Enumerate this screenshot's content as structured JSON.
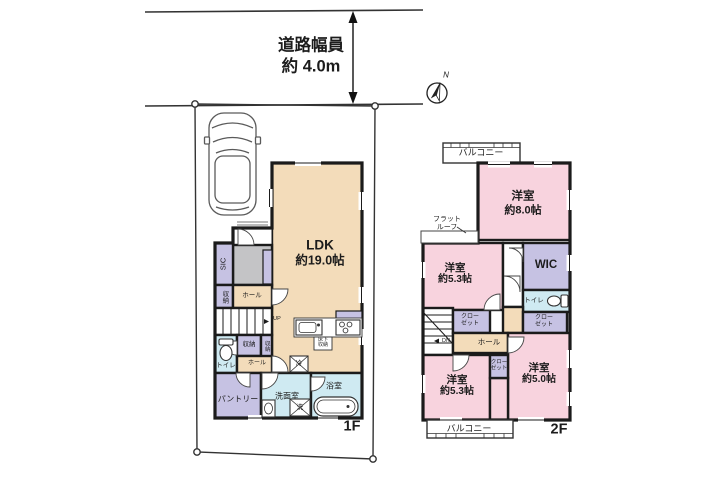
{
  "annotations": {
    "road_width_line1": "道路幅員",
    "road_width_line2": "約 4.0m",
    "compass_north": "N"
  },
  "colors": {
    "floor_beige": "#f3dcba",
    "bedroom_pink": "#f8d3de",
    "storage_purple": "#c6c2e3",
    "wet_blue": "#cfeaf2",
    "entrance_gray": "#c4c4c6",
    "wall_black": "#1b1b1b"
  },
  "floor1": {
    "floor_label": "1F",
    "ldk": {
      "name": "LDK",
      "size": "約19.0帖"
    },
    "sic": "SIC",
    "storage_a": "収納",
    "hall_a": "ホール",
    "up": "UP",
    "toilet": "トイレ",
    "storage_b": "収納",
    "storage_c": "収納",
    "hall_b": "ホール",
    "pantry": "パントリー",
    "washroom": "洗面室",
    "bathroom": "浴室",
    "fridge": "冷",
    "washer": "洗",
    "underfloor_l1": "床下",
    "underfloor_l2": "収納"
  },
  "floor2": {
    "floor_label": "2F",
    "balcony_top": "バルコニー",
    "balcony_bottom": "バルコニー",
    "flat_roof_l1": "フラット",
    "flat_roof_l2": "ルーフ",
    "bedroom8": {
      "name": "洋室",
      "size": "約8.0帖"
    },
    "bedroom53a": {
      "name": "洋室",
      "size": "約5.3帖"
    },
    "bedroom53b": {
      "name": "洋室",
      "size": "約5.3帖"
    },
    "bedroom50": {
      "name": "洋室",
      "size": "約5.0帖"
    },
    "wic": "WIC",
    "toilet": "トイレ",
    "closet_a_l1": "クロー",
    "closet_a_l2": "ゼット",
    "closet_b_l1": "クロー",
    "closet_b_l2": "ゼット",
    "closet_c_l1": "クロー",
    "closet_c_l2": "ゼット",
    "hall": "ホール",
    "dn": "DN"
  }
}
